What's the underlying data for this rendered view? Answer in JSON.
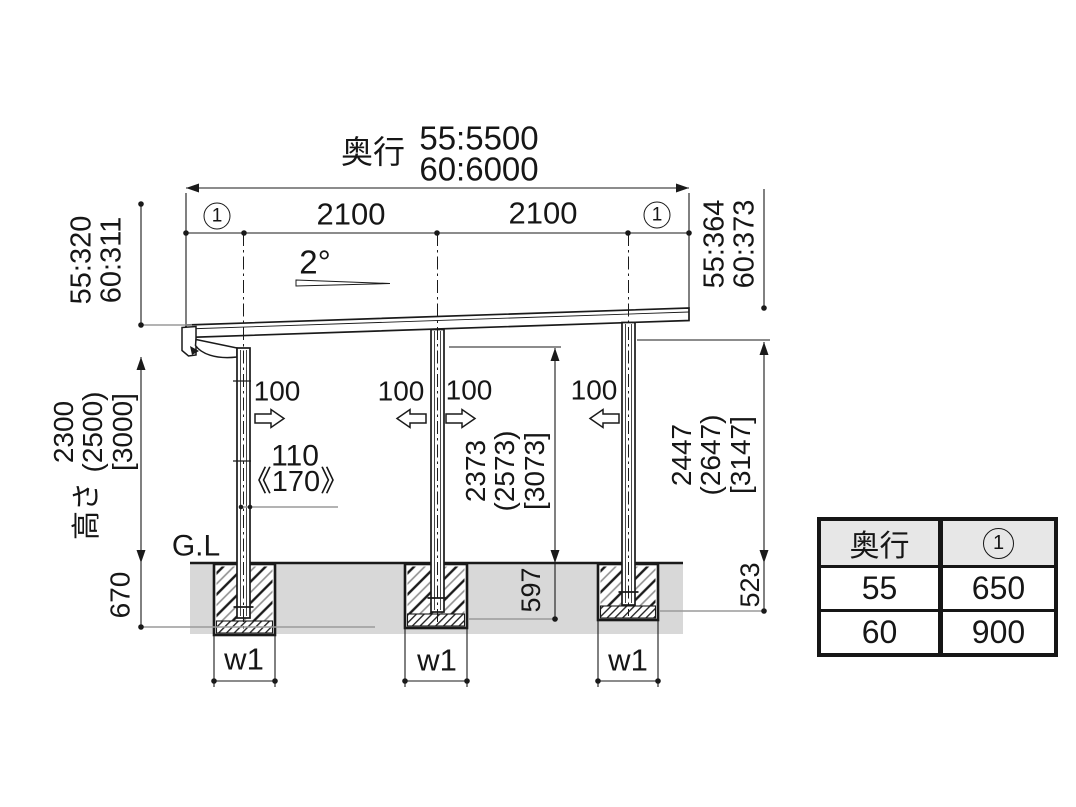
{
  "colors": {
    "line": "#1a1a1a",
    "ground_fill": "#d8d8d8",
    "dim_gray": "#9a9a9a",
    "table_header_bg": "#e7e7e7"
  },
  "header": {
    "depth_label": "奥行",
    "depth_55": "55:5500",
    "depth_60": "60:6000",
    "span_front": "2100",
    "span_rear": "2100",
    "overhang_mark": "1"
  },
  "left_dims": {
    "edge_55": "55:320",
    "edge_60": "60:311",
    "height": "2300",
    "height_paren": "(2500)",
    "height_bracket": "[3000]",
    "height_label": "高さ",
    "footing_depth": "670"
  },
  "right_dims": {
    "edge_55": "55:364",
    "edge_60": "60:373",
    "clearance": "2447",
    "clearance_paren": "(2647)",
    "clearance_bracket": "[3147]",
    "footing_depth": "523"
  },
  "mid_dims": {
    "slope": "2°",
    "offsets": [
      "100",
      "100",
      "100",
      "100"
    ],
    "post_inset": "110",
    "post_inset_alt": "《170》",
    "clearance": "2373",
    "clearance_paren": "(2573)",
    "clearance_bracket": "[3073]",
    "footing_depth": "597"
  },
  "ground": {
    "gl_label": "G.L",
    "footing_width_label": "w1"
  },
  "table": {
    "header_depth": "奥行",
    "header_mark": "1",
    "rows": [
      {
        "depth": "55",
        "value": "650"
      },
      {
        "depth": "60",
        "value": "900"
      }
    ]
  }
}
